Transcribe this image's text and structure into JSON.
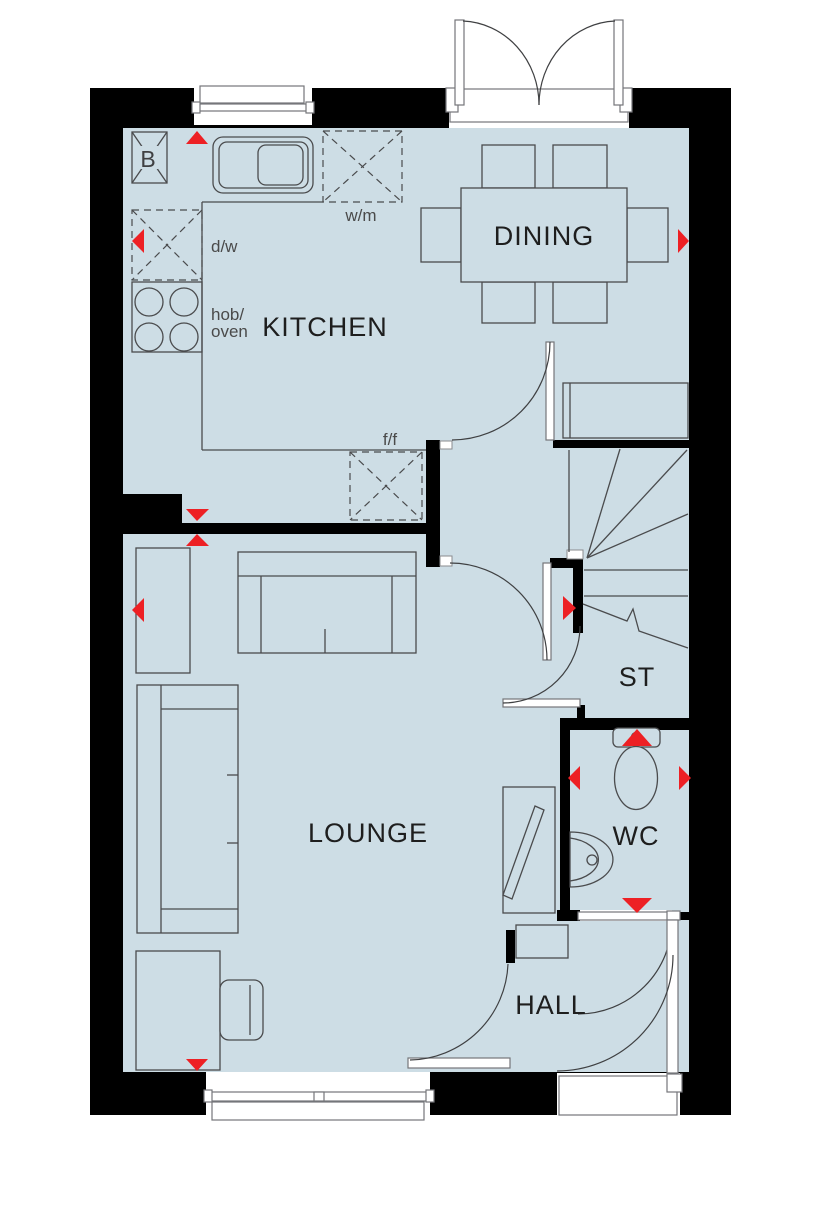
{
  "plan": {
    "type": "ground-floor-plan",
    "rooms": {
      "kitchen": "KITCHEN",
      "dining": "DINING",
      "lounge": "LOUNGE",
      "hall": "HALL",
      "wc": "WC",
      "stairs": "ST"
    },
    "appliances": {
      "boiler": "B",
      "washing_machine": "w/m",
      "dishwasher": "d/w",
      "hob_oven_line1": "hob/",
      "hob_oven_line2": "oven",
      "fridge_freezer": "f/f"
    },
    "colors": {
      "floor": "#cddde5",
      "wall": "#000000",
      "marker_red": "#ed2024",
      "furniture_line": "#4a4b4d",
      "opening_white": "#ffffff"
    },
    "marker_count": 12
  }
}
